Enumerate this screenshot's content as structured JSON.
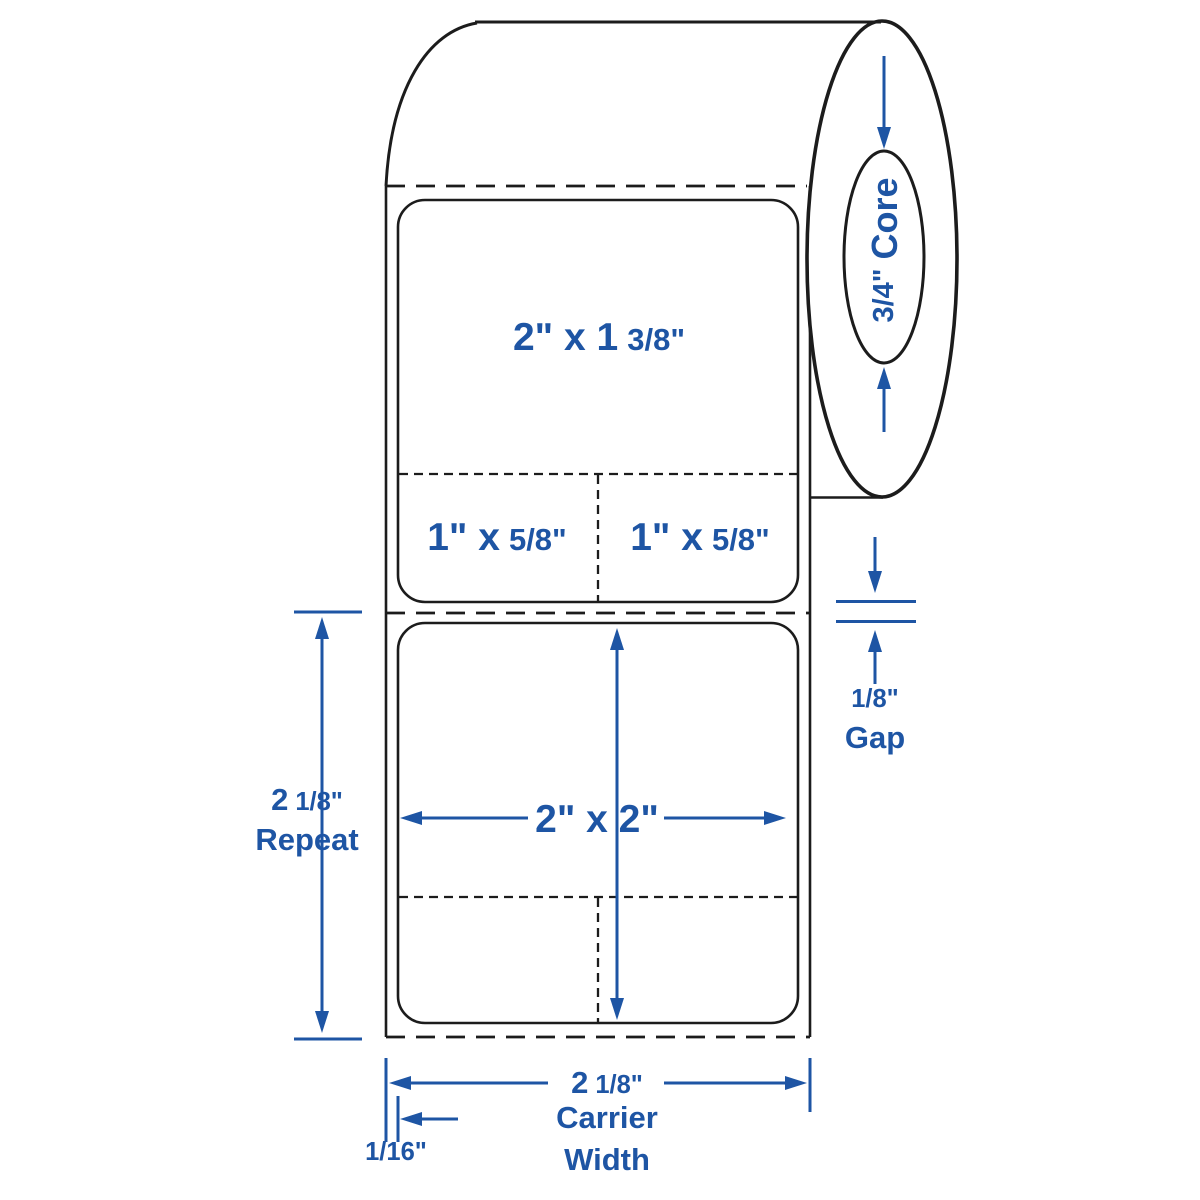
{
  "colors": {
    "accent": "#1e55a4",
    "outline": "#1c1c1c",
    "background": "#ffffff"
  },
  "core": {
    "fraction": "3/4\"",
    "word": "Core"
  },
  "label1": {
    "size_whole": "2\" x 1",
    "size_fraction": "3/8\"",
    "left_whole": "1\" x",
    "left_fraction": "5/8\"",
    "right_whole": "1\" x",
    "right_fraction": "5/8\""
  },
  "label2": {
    "size": "2\" x 2\""
  },
  "repeat": {
    "whole": "2",
    "fraction": "1/8\"",
    "word": "Repeat"
  },
  "gap": {
    "fraction": "1/8\"",
    "word": "Gap"
  },
  "carrier": {
    "whole": "2",
    "fraction": "1/8\"",
    "word1": "Carrier",
    "word2": "Width"
  },
  "edge_offset": {
    "fraction": "1/16\""
  }
}
